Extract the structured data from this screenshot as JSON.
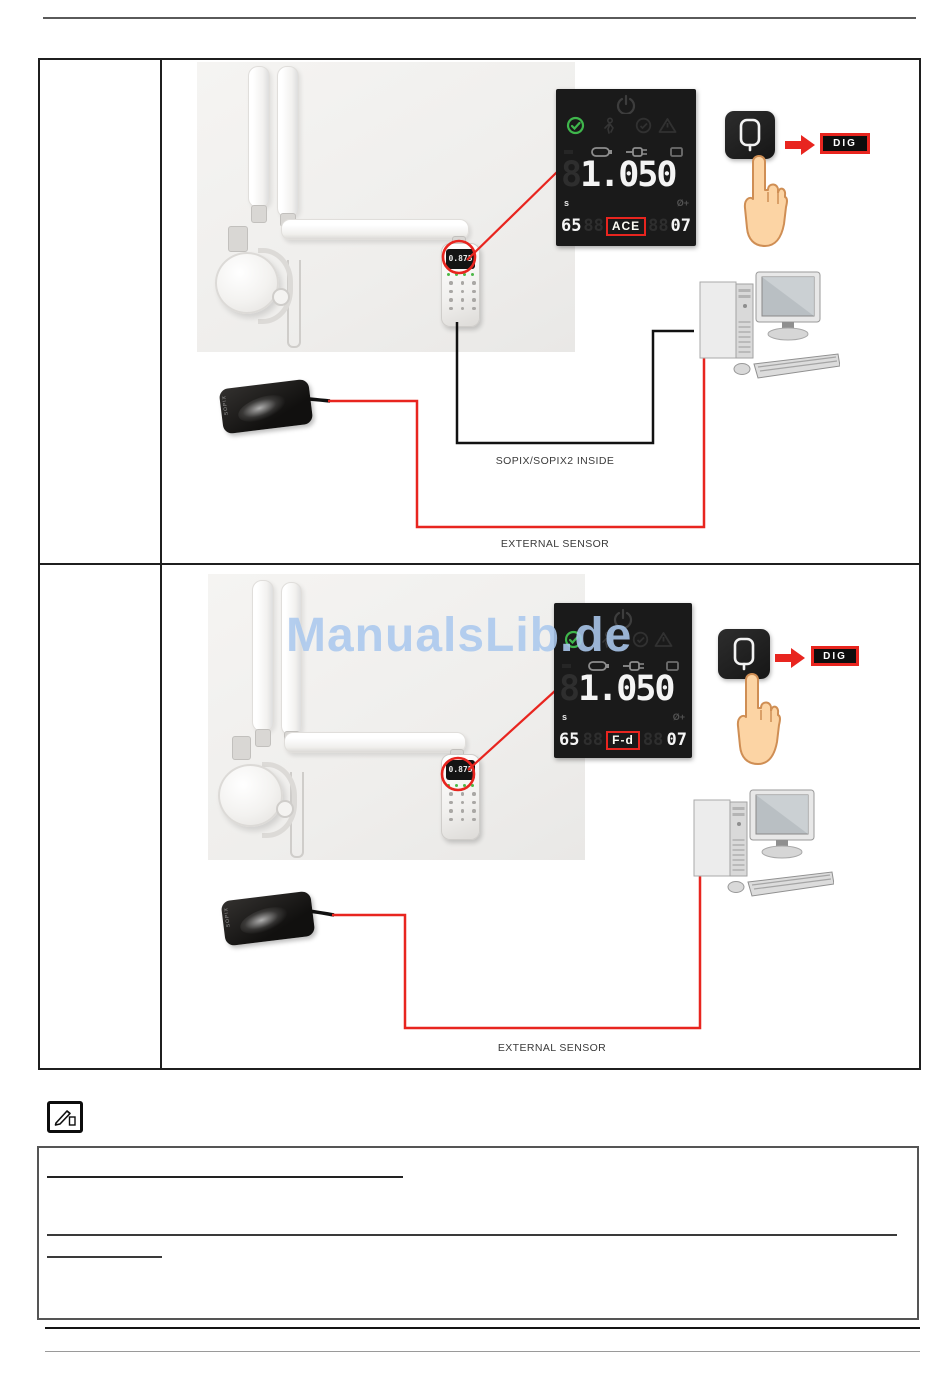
{
  "watermark": {
    "text": "ManualsLib.de",
    "color": "#abc9ee"
  },
  "colors": {
    "accent_red": "#e8251f",
    "panel_bg": "#1a1a1a",
    "status_green": "#3fb64c",
    "photo_bg": "#f0efec"
  },
  "rows": [
    {
      "remote": {
        "value": "0.875"
      },
      "panel": {
        "ghost_digit": "8",
        "exposure_time": "1.050",
        "seconds_unit": "s",
        "aux_symbol": "Ø+",
        "kv": "65",
        "ghost_pair_left": "88",
        "mode": "ACE",
        "ghost_pair_right": "88",
        "ma": "07"
      },
      "dig_button_label": "DIG",
      "sensor_brand": "SOPIX",
      "labels": {
        "inside": "SOPIX/SOPIX2 INSIDE",
        "external": "EXTERNAL SENSOR"
      }
    },
    {
      "remote": {
        "value": "0.875"
      },
      "panel": {
        "ghost_digit": "8",
        "exposure_time": "1.050",
        "seconds_unit": "s",
        "aux_symbol": "Ø+",
        "kv": "65",
        "ghost_pair_left": "88",
        "mode": "F-d",
        "ghost_pair_right": "88",
        "ma": "07"
      },
      "dig_button_label": "DIG",
      "sensor_brand": "SOPIX",
      "labels": {
        "external": "EXTERNAL SENSOR"
      }
    }
  ]
}
